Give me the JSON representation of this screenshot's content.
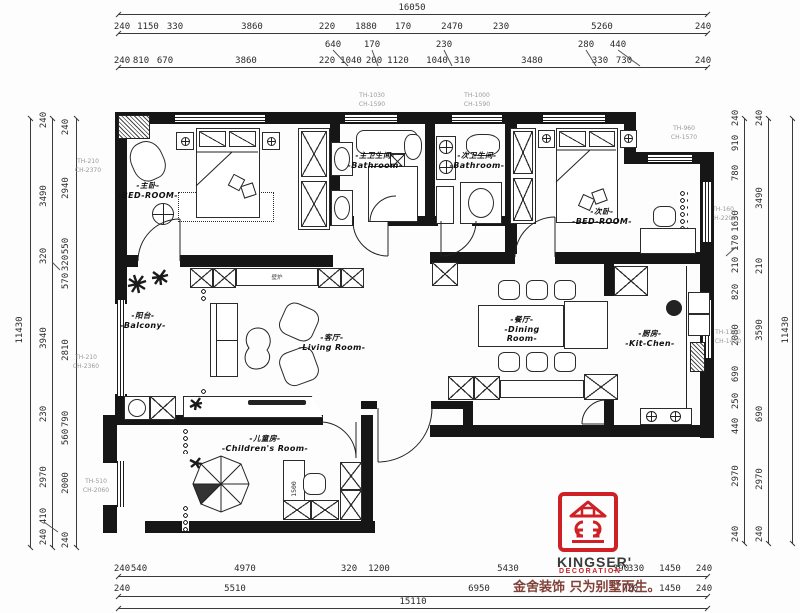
{
  "rooms": {
    "master_bedroom": {
      "cn": "-主卧-",
      "en": "-BED-ROOM-"
    },
    "master_bath": {
      "cn": "-主卫生间-",
      "en": "-Bathroom-"
    },
    "second_bath": {
      "cn": "-次卫生间-",
      "en": "-Bathroom-"
    },
    "second_bedroom": {
      "cn": "-次卧-",
      "en": "-BED-ROOM-"
    },
    "balcony": {
      "cn": "-阳台-",
      "en": "-Balcony-"
    },
    "living": {
      "cn": "-客厅-",
      "en": "-Living Room-"
    },
    "dining": {
      "cn": "-餐厅-",
      "en": "-Dining Room-"
    },
    "kitchen": {
      "cn": "-厨房-",
      "en": "-Kit-Chen-"
    },
    "children": {
      "cn": "-儿童房-",
      "en": "-Children's Room-"
    }
  },
  "fixtures": {
    "fireplace": "壁炉",
    "desk_length": "1500"
  },
  "window_tags": [
    {
      "t": "TH-1030\nCH-1590",
      "x": 372,
      "y": 100
    },
    {
      "t": "TH-1000\nCH-1590",
      "x": 477,
      "y": 100
    },
    {
      "t": "TH-960\nCH-1570",
      "x": 684,
      "y": 133
    },
    {
      "t": "TH-160\nCH-2200",
      "x": 723,
      "y": 214
    },
    {
      "t": "TH-1100\nCH-1450",
      "x": 728,
      "y": 337
    },
    {
      "t": "TH-210\nCH-2370",
      "x": 88,
      "y": 166
    },
    {
      "t": "TH-210\nCH-2360",
      "x": 86,
      "y": 362
    },
    {
      "t": "TH-510\nCH-2060",
      "x": 96,
      "y": 486
    }
  ],
  "dimensions": {
    "groups": [
      {
        "name": "top-total",
        "orient": "h",
        "labels": [
          {
            "t": "16050",
            "x": 412,
            "y": 8
          }
        ]
      },
      {
        "name": "top-row-1",
        "orient": "h",
        "labels": [
          {
            "t": "240",
            "x": 122,
            "y": 27
          },
          {
            "t": "1150",
            "x": 148,
            "y": 27
          },
          {
            "t": "330",
            "x": 175,
            "y": 27
          },
          {
            "t": "3860",
            "x": 252,
            "y": 27
          },
          {
            "t": "220",
            "x": 327,
            "y": 27
          },
          {
            "t": "1880",
            "x": 366,
            "y": 27
          },
          {
            "t": "170",
            "x": 403,
            "y": 27
          },
          {
            "t": "2470",
            "x": 452,
            "y": 27
          },
          {
            "t": "230",
            "x": 501,
            "y": 27
          },
          {
            "t": "5260",
            "x": 602,
            "y": 27
          },
          {
            "t": "240",
            "x": 703,
            "y": 27
          }
        ]
      },
      {
        "name": "top-callouts",
        "orient": "h",
        "labels": [
          {
            "t": "640",
            "x": 333,
            "y": 45
          },
          {
            "t": "170",
            "x": 372,
            "y": 45
          },
          {
            "t": "230",
            "x": 444,
            "y": 45
          },
          {
            "t": "280",
            "x": 586,
            "y": 45
          },
          {
            "t": "440",
            "x": 618,
            "y": 45
          }
        ]
      },
      {
        "name": "top-row-2",
        "orient": "h",
        "labels": [
          {
            "t": "240",
            "x": 122,
            "y": 61
          },
          {
            "t": "810",
            "x": 141,
            "y": 61
          },
          {
            "t": "670",
            "x": 165,
            "y": 61
          },
          {
            "t": "3860",
            "x": 246,
            "y": 61
          },
          {
            "t": "220",
            "x": 327,
            "y": 61
          },
          {
            "t": "1040",
            "x": 351,
            "y": 61
          },
          {
            "t": "200",
            "x": 374,
            "y": 61
          },
          {
            "t": "1120",
            "x": 398,
            "y": 61
          },
          {
            "t": "1040",
            "x": 437,
            "y": 61
          },
          {
            "t": "310",
            "x": 462,
            "y": 61
          },
          {
            "t": "3480",
            "x": 532,
            "y": 61
          },
          {
            "t": "330",
            "x": 600,
            "y": 61
          },
          {
            "t": "730",
            "x": 624,
            "y": 61
          },
          {
            "t": "240",
            "x": 703,
            "y": 61
          }
        ]
      },
      {
        "name": "bottom-row-1",
        "orient": "h",
        "labels": [
          {
            "t": "240",
            "x": 122,
            "y": 569
          },
          {
            "t": "540",
            "x": 139,
            "y": 569
          },
          {
            "t": "4970",
            "x": 245,
            "y": 569
          },
          {
            "t": "320",
            "x": 349,
            "y": 569
          },
          {
            "t": "1200",
            "x": 379,
            "y": 569
          },
          {
            "t": "5430",
            "x": 508,
            "y": 569
          },
          {
            "t": "390",
            "x": 621,
            "y": 569
          },
          {
            "t": "330",
            "x": 636,
            "y": 569
          },
          {
            "t": "1450",
            "x": 670,
            "y": 569
          },
          {
            "t": "240",
            "x": 704,
            "y": 569
          }
        ]
      },
      {
        "name": "bottom-row-2",
        "orient": "h",
        "labels": [
          {
            "t": "240",
            "x": 122,
            "y": 589
          },
          {
            "t": "5510",
            "x": 235,
            "y": 589
          },
          {
            "t": "6950",
            "x": 479,
            "y": 589
          },
          {
            "t": "720",
            "x": 630,
            "y": 589
          },
          {
            "t": "1450",
            "x": 670,
            "y": 589
          },
          {
            "t": "240",
            "x": 704,
            "y": 589
          }
        ]
      },
      {
        "name": "bottom-total",
        "orient": "h",
        "labels": [
          {
            "t": "15110",
            "x": 413,
            "y": 602
          }
        ]
      },
      {
        "name": "left-col-inner",
        "orient": "v",
        "labels": [
          {
            "t": "240",
            "x": 66,
            "y": 127
          },
          {
            "t": "2940",
            "x": 66,
            "y": 188
          },
          {
            "t": "550",
            "x": 66,
            "y": 246
          },
          {
            "t": "320",
            "x": 66,
            "y": 263
          },
          {
            "t": "570",
            "x": 66,
            "y": 281
          },
          {
            "t": "2810",
            "x": 66,
            "y": 350
          },
          {
            "t": "790",
            "x": 66,
            "y": 419
          },
          {
            "t": "560",
            "x": 66,
            "y": 437
          },
          {
            "t": "2000",
            "x": 66,
            "y": 483
          },
          {
            "t": "240",
            "x": 66,
            "y": 540
          }
        ]
      },
      {
        "name": "left-col-mid",
        "orient": "v",
        "labels": [
          {
            "t": "240",
            "x": 44,
            "y": 120
          },
          {
            "t": "3490",
            "x": 44,
            "y": 196
          },
          {
            "t": "320",
            "x": 44,
            "y": 256
          },
          {
            "t": "3940",
            "x": 44,
            "y": 338
          },
          {
            "t": "230",
            "x": 44,
            "y": 414
          },
          {
            "t": "2970",
            "x": 44,
            "y": 477
          },
          {
            "t": "410",
            "x": 44,
            "y": 516
          },
          {
            "t": "240",
            "x": 44,
            "y": 537
          }
        ]
      },
      {
        "name": "left-total",
        "orient": "v",
        "labels": [
          {
            "t": "11430",
            "x": 20,
            "y": 330
          }
        ]
      },
      {
        "name": "right-col-inner",
        "orient": "v",
        "labels": [
          {
            "t": "240",
            "x": 736,
            "y": 118
          },
          {
            "t": "910",
            "x": 736,
            "y": 143
          },
          {
            "t": "780",
            "x": 736,
            "y": 173
          },
          {
            "t": "1630",
            "x": 736,
            "y": 221
          },
          {
            "t": "170",
            "x": 736,
            "y": 243
          },
          {
            "t": "210",
            "x": 736,
            "y": 265
          },
          {
            "t": "820",
            "x": 736,
            "y": 292
          },
          {
            "t": "2080",
            "x": 736,
            "y": 335
          },
          {
            "t": "690",
            "x": 736,
            "y": 374
          },
          {
            "t": "250",
            "x": 736,
            "y": 401
          },
          {
            "t": "440",
            "x": 736,
            "y": 426
          },
          {
            "t": "2970",
            "x": 736,
            "y": 476
          },
          {
            "t": "240",
            "x": 736,
            "y": 534
          }
        ]
      },
      {
        "name": "right-col-mid",
        "orient": "v",
        "labels": [
          {
            "t": "240",
            "x": 760,
            "y": 118
          },
          {
            "t": "3490",
            "x": 760,
            "y": 198
          },
          {
            "t": "210",
            "x": 760,
            "y": 266
          },
          {
            "t": "3590",
            "x": 760,
            "y": 330
          },
          {
            "t": "690",
            "x": 760,
            "y": 414
          },
          {
            "t": "2970",
            "x": 760,
            "y": 479
          },
          {
            "t": "240",
            "x": 760,
            "y": 534
          }
        ]
      },
      {
        "name": "right-total",
        "orient": "v",
        "labels": [
          {
            "t": "11430",
            "x": 786,
            "y": 330
          }
        ]
      }
    ]
  },
  "logo": {
    "brand": "KINGSER'",
    "sub": "DECORATION",
    "tagline": "金舍装饰 只为别墅而生。",
    "red": "#cf2026"
  }
}
